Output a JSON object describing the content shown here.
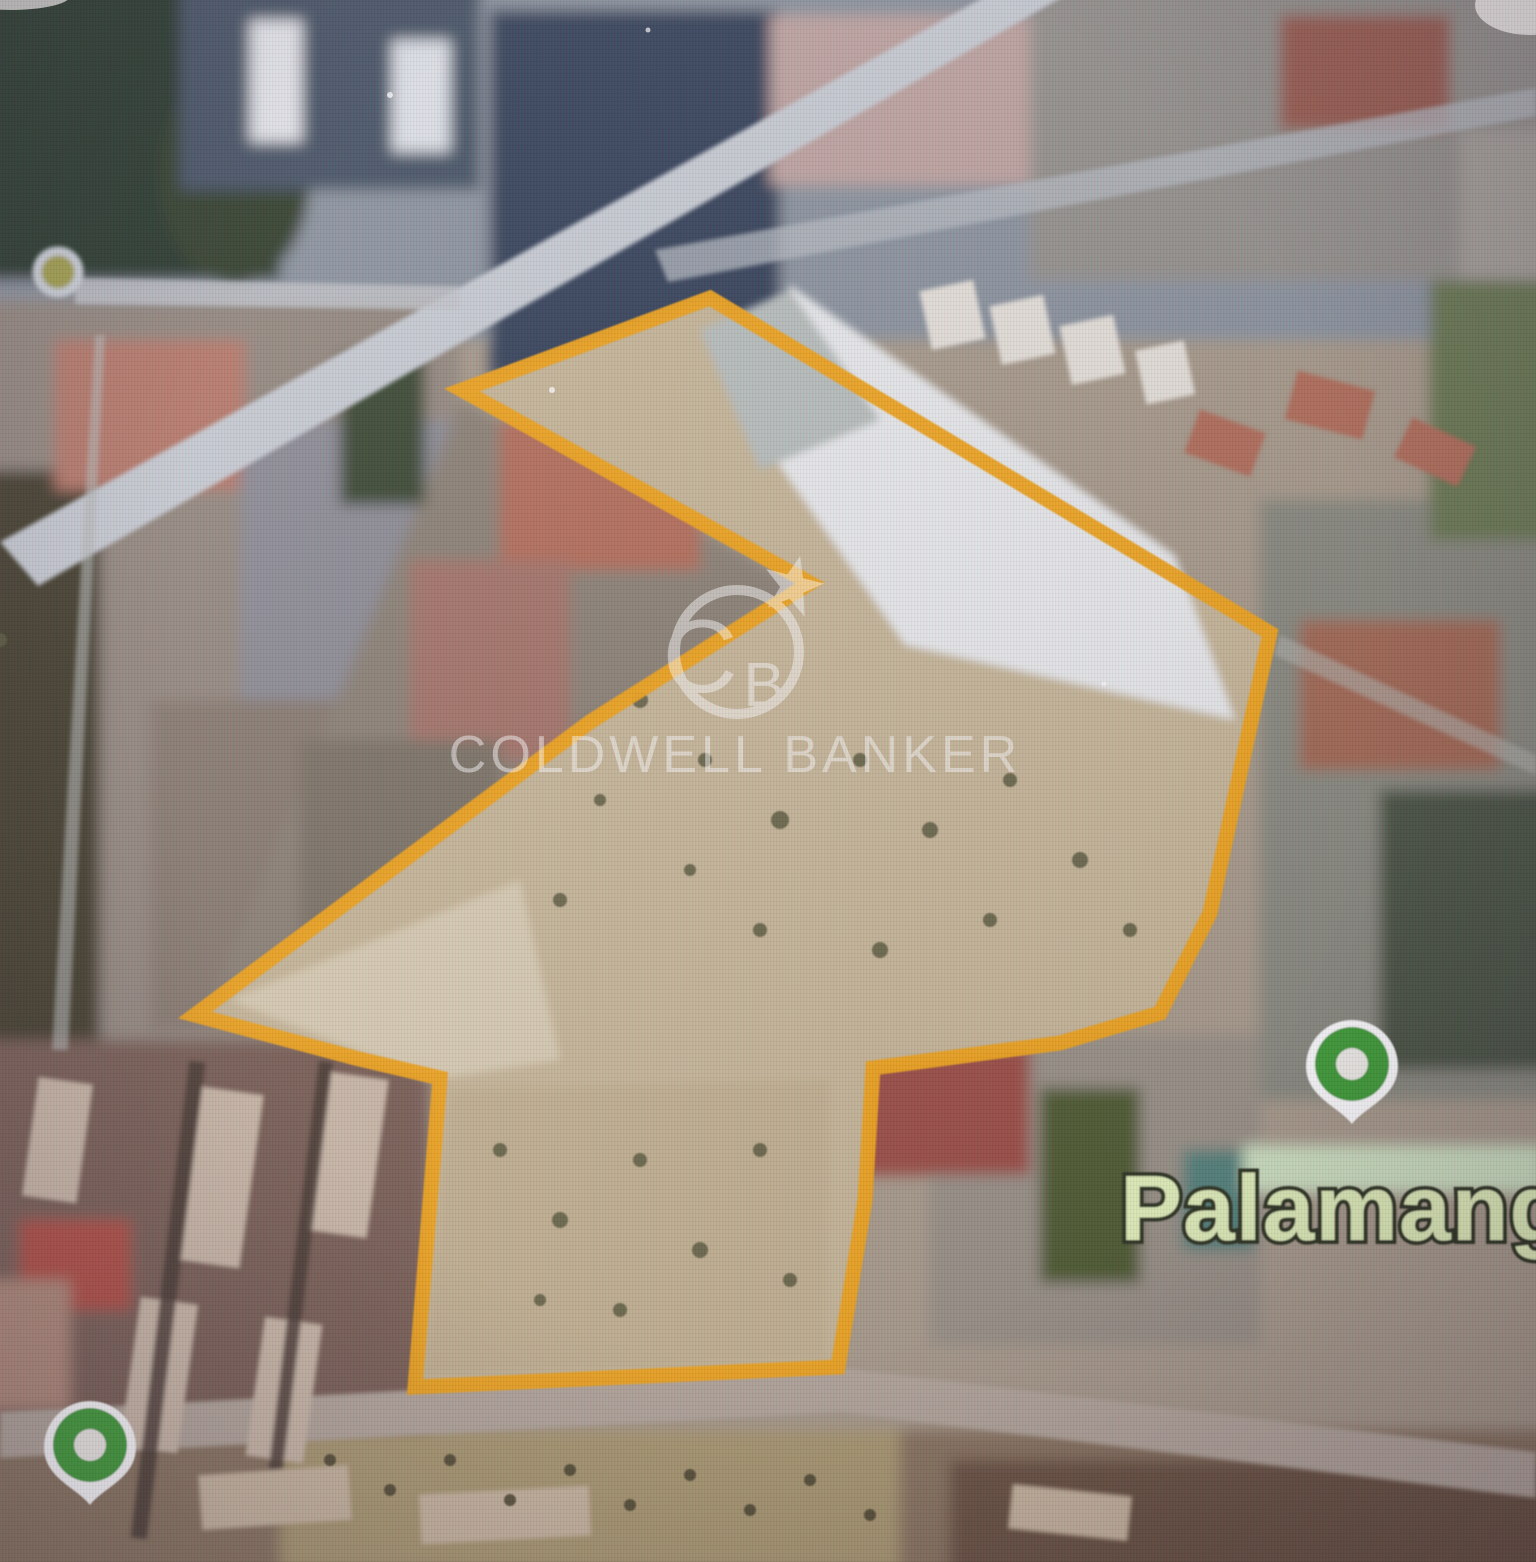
{
  "map": {
    "watermark": {
      "brand_line": "COLDWELL BANKER",
      "monogram_c": "C",
      "monogram_b": "B",
      "color": "#ffffff"
    },
    "labels": {
      "venue": "Palamangano",
      "venue_fill": "#e3f2bb",
      "venue_outline": "#2e3420"
    },
    "parcel": {
      "points": "710,298 1270,633 1210,913 1160,1013 1060,1043 873,1068 865,1200 838,1367 415,1387 440,1078 355,1058 195,1015 590,722 810,583 462,390",
      "stroke": "#F1A51F"
    },
    "pins": [
      {
        "name": "pin-palamangano",
        "transform": "translate(1352,1124)",
        "color": "#3F9E39"
      },
      {
        "name": "pin-bottom-left",
        "transform": "translate(90,1505)",
        "color": "#3F9E39"
      }
    ]
  }
}
